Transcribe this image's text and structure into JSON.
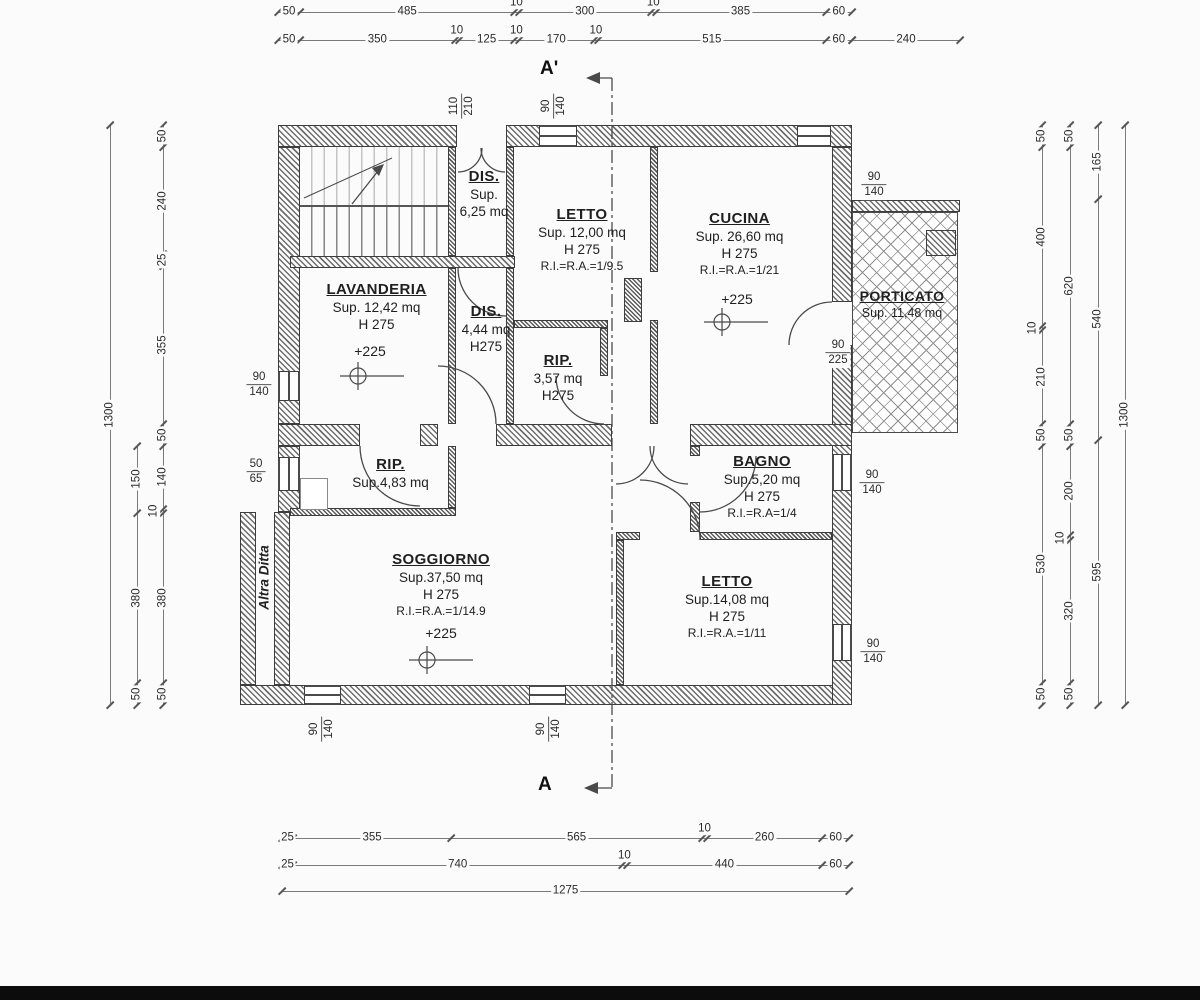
{
  "section": {
    "top_label": "A'",
    "bottom_label": "A"
  },
  "annotations": {
    "party_wall": "Altra Ditta"
  },
  "rooms": [
    {
      "id": "dis-top",
      "name": "DIS.",
      "lines": [
        "Sup.",
        "6,25 mq"
      ]
    },
    {
      "id": "letto-nord",
      "name": "LETTO",
      "lines": [
        "Sup. 12,00 mq",
        "H 275",
        "R.I.=R.A.=1/9.5"
      ]
    },
    {
      "id": "cucina",
      "name": "CUCINA",
      "lines": [
        "Sup. 26,60 mq",
        "H 275",
        "R.I.=R.A.=1/21"
      ]
    },
    {
      "id": "porticato",
      "name": "PORTICATO",
      "lines": [
        "Sup. 11,48 mq"
      ]
    },
    {
      "id": "lavanderia",
      "name": "LAVANDERIA",
      "lines": [
        "Sup. 12,42 mq",
        "H 275"
      ]
    },
    {
      "id": "dis-centro",
      "name": "DIS.",
      "lines": [
        "4,44 mq",
        "H275"
      ]
    },
    {
      "id": "rip-centro",
      "name": "RIP.",
      "lines": [
        "3,57 mq",
        "H275"
      ]
    },
    {
      "id": "rip-ovest",
      "name": "RIP.",
      "lines": [
        "Sup.4,83 mq"
      ]
    },
    {
      "id": "soggiorno",
      "name": "SOGGIORNO",
      "lines": [
        "Sup.37,50 mq",
        "H 275",
        "R.I.=R.A.=1/14.9"
      ]
    },
    {
      "id": "bagno",
      "name": "BAGNO",
      "lines": [
        "Sup.5,20 mq",
        "H 275",
        "R.I.=R.A=1/4"
      ]
    },
    {
      "id": "letto-sud",
      "name": "LETTO",
      "lines": [
        "Sup.14,08 mq",
        "H 275",
        "R.I.=R.A.=1/11"
      ]
    }
  ],
  "level_markers": [
    {
      "label": "+225"
    },
    {
      "label": "+225"
    },
    {
      "label": "+225"
    }
  ],
  "dimension_chains": [
    {
      "id": "top-row-1",
      "values": [
        50,
        485,
        10,
        300,
        10,
        385,
        60
      ]
    },
    {
      "id": "top-row-2",
      "values": [
        50,
        350,
        10,
        125,
        10,
        170,
        10,
        515,
        60
      ]
    },
    {
      "id": "top-porticato",
      "values": [
        240
      ]
    },
    {
      "id": "bottom-row-1",
      "values": [
        25,
        355,
        565,
        10,
        260,
        60
      ]
    },
    {
      "id": "bottom-row-2",
      "values": [
        25,
        740,
        10,
        440,
        60
      ]
    },
    {
      "id": "bottom-total",
      "values": [
        1275
      ]
    },
    {
      "id": "left-inner",
      "values": [
        50,
        240,
        25,
        355,
        50,
        140,
        10,
        380,
        50
      ]
    },
    {
      "id": "left-middle",
      "values": [
        150,
        380,
        50
      ]
    },
    {
      "id": "left-total",
      "values": [
        1300
      ]
    },
    {
      "id": "right-1",
      "values": [
        50,
        400,
        10,
        210,
        50,
        530,
        50
      ]
    },
    {
      "id": "right-2",
      "values": [
        50,
        620,
        50,
        200,
        10,
        320,
        50
      ]
    },
    {
      "id": "right-3",
      "values": [
        165,
        540,
        595
      ]
    },
    {
      "id": "right-total",
      "values": [
        1300
      ]
    }
  ],
  "opening_dims": [
    {
      "num": "110",
      "den": "210"
    },
    {
      "num": "90",
      "den": "140"
    },
    {
      "num": "90",
      "den": "140"
    },
    {
      "num": "90",
      "den": "225"
    },
    {
      "num": "90",
      "den": "140"
    },
    {
      "num": "50",
      "den": "65"
    },
    {
      "num": "90",
      "den": "140"
    },
    {
      "num": "90",
      "den": "140"
    },
    {
      "num": "90",
      "den": "140"
    },
    {
      "num": "90",
      "den": "140"
    }
  ]
}
